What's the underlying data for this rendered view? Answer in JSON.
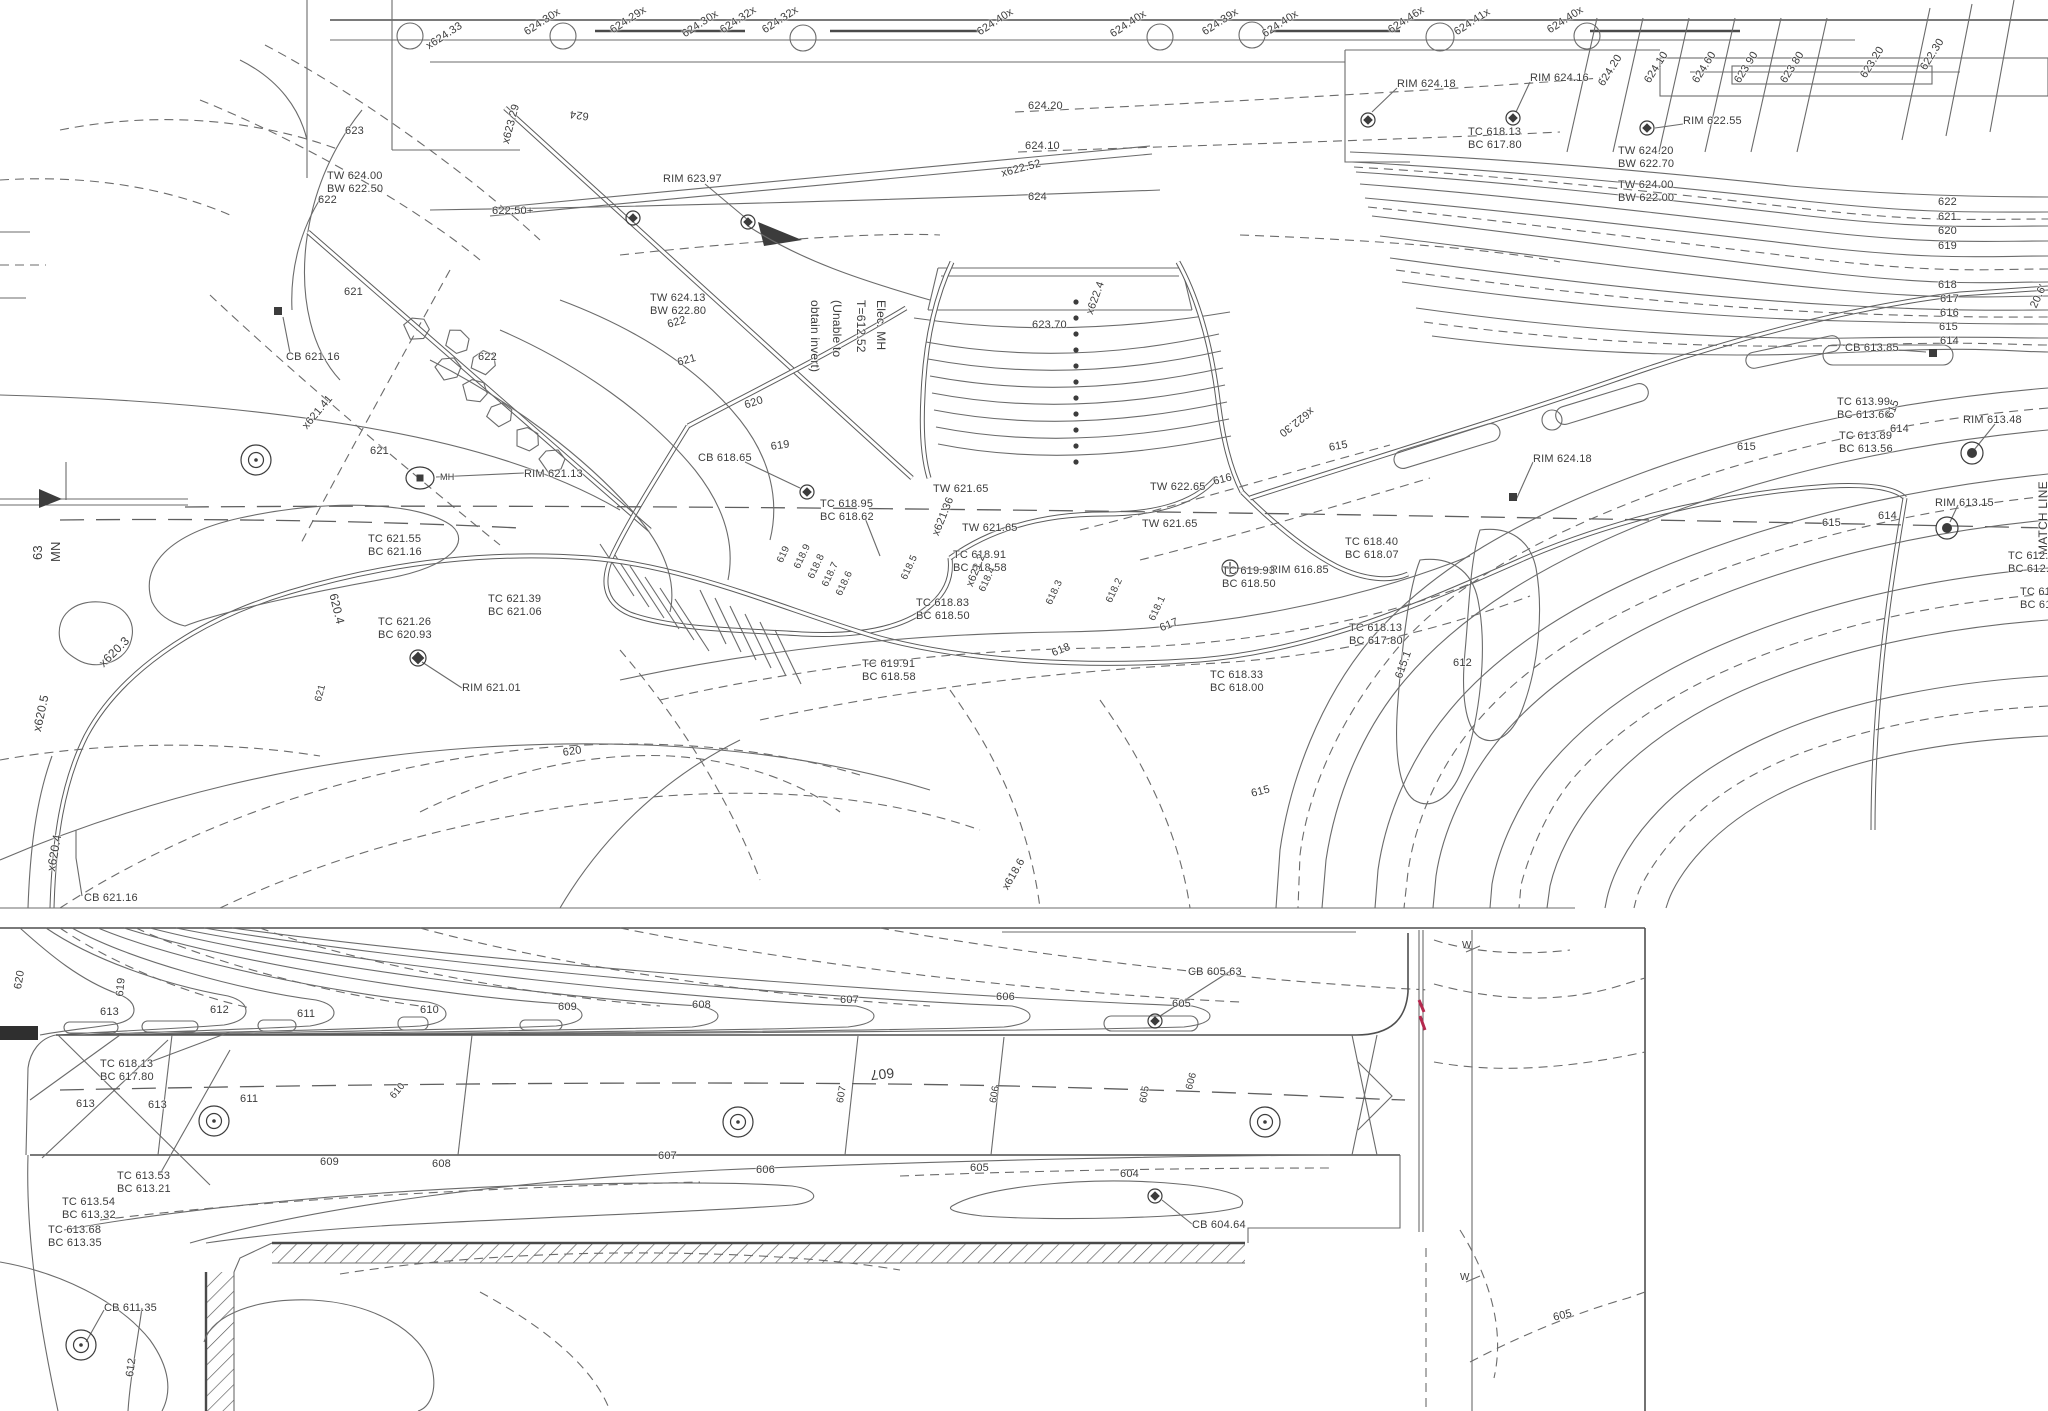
{
  "title": "site-grading-topographic-plan",
  "colors": {
    "paper": "#ffffff",
    "ink": "#3c3c3c",
    "line": "#6b6b6b",
    "flag": "#b5294e"
  },
  "panels": {
    "top": "plan-view-upper",
    "bottom": "plan-view-lower"
  },
  "notes": {
    "elec_mh": [
      "Elec. MH",
      "T=612.52",
      "(Unable to",
      "obtain invert)"
    ],
    "match_line": "MATCH LINE",
    "route": [
      "MN",
      "63"
    ]
  },
  "labels": [
    {
      "t": "x624.33",
      "x": 424,
      "y": 42,
      "r": -33
    },
    {
      "t": "624.30x",
      "x": 522,
      "y": 28,
      "r": -33
    },
    {
      "t": "624.29x",
      "x": 608,
      "y": 26,
      "r": -33
    },
    {
      "t": "624.30x",
      "x": 680,
      "y": 30,
      "r": -33
    },
    {
      "t": "624.32x",
      "x": 718,
      "y": 26,
      "r": -33
    },
    {
      "t": "624.32x",
      "x": 760,
      "y": 26,
      "r": -33
    },
    {
      "t": "624.40x",
      "x": 975,
      "y": 28,
      "r": -33
    },
    {
      "t": "624.40x",
      "x": 1108,
      "y": 30,
      "r": -33
    },
    {
      "t": "624.39x",
      "x": 1200,
      "y": 28,
      "r": -33
    },
    {
      "t": "624.40x",
      "x": 1260,
      "y": 30,
      "r": -33
    },
    {
      "t": "624.46x",
      "x": 1386,
      "y": 26,
      "r": -33
    },
    {
      "t": "624.41x",
      "x": 1452,
      "y": 28,
      "r": -33
    },
    {
      "t": "624.40x",
      "x": 1545,
      "y": 26,
      "r": -33
    },
    {
      "t": "624.20",
      "x": 1596,
      "y": 82,
      "r": -58
    },
    {
      "t": "624.10",
      "x": 1642,
      "y": 79,
      "r": -58
    },
    {
      "t": "624.60",
      "x": 1690,
      "y": 79,
      "r": -58
    },
    {
      "t": "623.90",
      "x": 1732,
      "y": 79,
      "r": -58
    },
    {
      "t": "623.80",
      "x": 1778,
      "y": 79,
      "r": -58
    },
    {
      "t": "623.20",
      "x": 1858,
      "y": 74,
      "r": -58
    },
    {
      "t": "622.30",
      "x": 1918,
      "y": 66,
      "r": -58
    },
    {
      "t": "RIM 624.18",
      "x": 1397,
      "y": 78
    },
    {
      "t": "RIM 624.16",
      "x": 1530,
      "y": 72
    },
    {
      "t": "RIM 622.55",
      "x": 1683,
      "y": 115
    },
    {
      "t": "RIM 623.97",
      "x": 663,
      "y": 173
    },
    {
      "t": "TC 618.13\nBC 617.80",
      "x": 1468,
      "y": 126
    },
    {
      "t": "TW 624.20\nBW 622.70",
      "x": 1618,
      "y": 145
    },
    {
      "t": "TW 624.00\nBW 622.00",
      "x": 1618,
      "y": 179
    },
    {
      "t": "TW 624.00\nBW 622.50",
      "x": 327,
      "y": 170
    },
    {
      "t": "TW 624.13\nBW 622.80",
      "x": 650,
      "y": 292
    },
    {
      "t": "623",
      "x": 345,
      "y": 125
    },
    {
      "t": "622",
      "x": 318,
      "y": 194
    },
    {
      "t": "624.20",
      "x": 1028,
      "y": 100
    },
    {
      "t": "624.10",
      "x": 1025,
      "y": 140
    },
    {
      "t": "624",
      "x": 1028,
      "y": 191
    },
    {
      "t": "622.50+",
      "x": 492,
      "y": 205
    },
    {
      "t": "x623.29",
      "x": 500,
      "y": 142,
      "r": -75
    },
    {
      "t": "624",
      "x": 588,
      "y": 122,
      "r": 187
    },
    {
      "t": "x622.52",
      "x": 1000,
      "y": 168,
      "r": -15
    },
    {
      "t": "623.70",
      "x": 1032,
      "y": 319
    },
    {
      "t": "x622.4",
      "x": 1084,
      "y": 312,
      "r": -70
    },
    {
      "t": "x622.30",
      "x": 1316,
      "y": 414,
      "r": 142
    },
    {
      "t": "622",
      "x": 1938,
      "y": 196
    },
    {
      "t": "621",
      "x": 1938,
      "y": 211
    },
    {
      "t": "620",
      "x": 1938,
      "y": 225
    },
    {
      "t": "619",
      "x": 1938,
      "y": 240
    },
    {
      "t": "618",
      "x": 1938,
      "y": 279
    },
    {
      "t": "617",
      "x": 1940,
      "y": 293
    },
    {
      "t": "616",
      "x": 1940,
      "y": 307
    },
    {
      "t": "615",
      "x": 1939,
      "y": 321
    },
    {
      "t": "614",
      "x": 1940,
      "y": 335
    },
    {
      "t": "CB 613.85",
      "x": 1845,
      "y": 342
    },
    {
      "t": "TC 613.99\nBC 613.66",
      "x": 1837,
      "y": 396
    },
    {
      "t": "TC 613.89\nBC 613.56",
      "x": 1839,
      "y": 430
    },
    {
      "t": "RIM 613.48",
      "x": 1963,
      "y": 414
    },
    {
      "t": "RIM 613.15",
      "x": 1935,
      "y": 497
    },
    {
      "t": "MATCH LINE",
      "x": 2036,
      "y": 555,
      "r": -90,
      "fs": 12
    },
    {
      "t": "TC 612.5\nBC 612.5",
      "x": 2008,
      "y": 550
    },
    {
      "t": "TC 612\nBC 612",
      "x": 2020,
      "y": 586
    },
    {
      "t": "20.6'",
      "x": 2028,
      "y": 305,
      "r": -65
    },
    {
      "t": "615",
      "x": 1737,
      "y": 441
    },
    {
      "t": "615",
      "x": 1884,
      "y": 416,
      "r": -70
    },
    {
      "t": "614",
      "x": 1890,
      "y": 423
    },
    {
      "t": "614",
      "x": 1878,
      "y": 510
    },
    {
      "t": "615",
      "x": 1822,
      "y": 517
    },
    {
      "t": "615.1",
      "x": 1393,
      "y": 676,
      "r": -70
    },
    {
      "t": "612",
      "x": 1453,
      "y": 657
    },
    {
      "t": "618",
      "x": 1050,
      "y": 648,
      "r": -22
    },
    {
      "t": "617",
      "x": 1158,
      "y": 623,
      "r": -22
    },
    {
      "t": "616",
      "x": 1212,
      "y": 476,
      "r": -14
    },
    {
      "t": "615",
      "x": 1328,
      "y": 442,
      "r": -10
    },
    {
      "t": "615",
      "x": 1250,
      "y": 788,
      "r": -14
    },
    {
      "t": "RIM 624.18",
      "x": 1533,
      "y": 453
    },
    {
      "t": "RIM 616.85",
      "x": 1270,
      "y": 564
    },
    {
      "t": "620",
      "x": 743,
      "y": 400,
      "r": -18
    },
    {
      "t": "621",
      "x": 676,
      "y": 357,
      "r": -15
    },
    {
      "t": "622",
      "x": 666,
      "y": 319,
      "r": -15
    },
    {
      "t": "619",
      "x": 770,
      "y": 441,
      "r": -8
    },
    {
      "t": "CB 618.65",
      "x": 698,
      "y": 452
    },
    {
      "t": "TC 618.95\nBC 618.62",
      "x": 820,
      "y": 498
    },
    {
      "t": "TW 621.65",
      "x": 933,
      "y": 483
    },
    {
      "t": "TW 621.65",
      "x": 962,
      "y": 522
    },
    {
      "t": "TW 621.65",
      "x": 1142,
      "y": 518
    },
    {
      "t": "TW 622.65",
      "x": 1150,
      "y": 481
    },
    {
      "t": "x621.36",
      "x": 930,
      "y": 533,
      "r": -68
    },
    {
      "t": "TC 618.91\nBC 618.58",
      "x": 953,
      "y": 549
    },
    {
      "t": "x621.2",
      "x": 964,
      "y": 584,
      "r": -68
    },
    {
      "t": "TC 618.83\nBC 618.50",
      "x": 916,
      "y": 597
    },
    {
      "t": "TC 619.91\nBC 618.58",
      "x": 862,
      "y": 658
    },
    {
      "t": "TC 619.93\nBC 618.50",
      "x": 1222,
      "y": 565
    },
    {
      "t": "TC 618.40\nBC 618.07",
      "x": 1345,
      "y": 536
    },
    {
      "t": "TC 618.13\nBC 617.80",
      "x": 1349,
      "y": 622
    },
    {
      "t": "TC 618.33\nBC 618.00",
      "x": 1210,
      "y": 669
    },
    {
      "t": "x618.6",
      "x": 1000,
      "y": 886,
      "r": -60
    },
    {
      "t": "619",
      "x": 775,
      "y": 560,
      "r": -65,
      "fs": 10
    },
    {
      "t": "618.9",
      "x": 792,
      "y": 566,
      "r": -65,
      "fs": 10
    },
    {
      "t": "618.8",
      "x": 806,
      "y": 576,
      "r": -65,
      "fs": 10
    },
    {
      "t": "618.7",
      "x": 820,
      "y": 584,
      "r": -65,
      "fs": 10
    },
    {
      "t": "618.6",
      "x": 834,
      "y": 593,
      "r": -65,
      "fs": 10
    },
    {
      "t": "618.5",
      "x": 899,
      "y": 577,
      "r": -65,
      "fs": 10
    },
    {
      "t": "618.4",
      "x": 977,
      "y": 589,
      "r": -65,
      "fs": 10
    },
    {
      "t": "618.3",
      "x": 1044,
      "y": 602,
      "r": -65,
      "fs": 10
    },
    {
      "t": "618.2",
      "x": 1104,
      "y": 600,
      "r": -65,
      "fs": 10
    },
    {
      "t": "618.1",
      "x": 1147,
      "y": 618,
      "r": -65,
      "fs": 10
    },
    {
      "t": "621",
      "x": 344,
      "y": 286
    },
    {
      "t": "CB 621.16",
      "x": 286,
      "y": 351
    },
    {
      "t": "x621.41",
      "x": 300,
      "y": 424,
      "r": -50
    },
    {
      "t": "622",
      "x": 478,
      "y": 351
    },
    {
      "t": "621",
      "x": 370,
      "y": 445
    },
    {
      "t": "MH",
      "x": 440,
      "y": 472,
      "fs": 9
    },
    {
      "t": "RIM 621.13",
      "x": 524,
      "y": 468
    },
    {
      "t": "TC 621.55\nBC 621.16",
      "x": 368,
      "y": 533
    },
    {
      "t": "TC 621.39\nBC 621.06",
      "x": 488,
      "y": 593
    },
    {
      "t": "TC 621.26\nBC 620.93",
      "x": 378,
      "y": 616
    },
    {
      "t": "RIM 621.01",
      "x": 462,
      "y": 682
    },
    {
      "t": "620.4",
      "x": 340,
      "y": 592,
      "r": 76,
      "fs": 12
    },
    {
      "t": "x620.3",
      "x": 96,
      "y": 660,
      "r": -45,
      "fs": 12
    },
    {
      "t": "x620.5",
      "x": 30,
      "y": 730,
      "r": -78,
      "fs": 12
    },
    {
      "t": "x620.4",
      "x": 44,
      "y": 870,
      "r": -80,
      "fs": 12
    },
    {
      "t": "621",
      "x": 313,
      "y": 700,
      "r": -75,
      "fs": 10
    },
    {
      "t": "620",
      "x": 562,
      "y": 747,
      "r": -8
    },
    {
      "t": "CB 621.16",
      "x": 84,
      "y": 892
    },
    {
      "t": "MN",
      "x": 48,
      "y": 562,
      "r": -90,
      "fs": 13
    },
    {
      "t": "63",
      "x": 30,
      "y": 560,
      "r": -90,
      "fs": 13
    },
    {
      "t": "Elec. MH",
      "x": 888,
      "y": 300,
      "r": 90,
      "fs": 12
    },
    {
      "t": "T=612.52",
      "x": 868,
      "y": 300,
      "r": 90,
      "fs": 12
    },
    {
      "t": "(Unable to",
      "x": 844,
      "y": 300,
      "r": 90,
      "fs": 12
    },
    {
      "t": "obtain invert)",
      "x": 822,
      "y": 300,
      "r": 90,
      "fs": 12
    },
    {
      "t": "613",
      "x": 100,
      "y": 1006
    },
    {
      "t": "612",
      "x": 210,
      "y": 1004
    },
    {
      "t": "611",
      "x": 297,
      "y": 1008
    },
    {
      "t": "610",
      "x": 420,
      "y": 1004
    },
    {
      "t": "609",
      "x": 558,
      "y": 1001
    },
    {
      "t": "608",
      "x": 692,
      "y": 999
    },
    {
      "t": "607",
      "x": 840,
      "y": 994
    },
    {
      "t": "606",
      "x": 996,
      "y": 991
    },
    {
      "t": "605",
      "x": 1172,
      "y": 998
    },
    {
      "t": "CB 605.63",
      "x": 1188,
      "y": 966
    },
    {
      "t": "610",
      "x": 388,
      "y": 1094,
      "r": -50,
      "fs": 10
    },
    {
      "t": "607",
      "x": 835,
      "y": 1102,
      "r": -80,
      "fs": 10
    },
    {
      "t": "607",
      "x": 895,
      "y": 1081,
      "r": 174,
      "fs": 14
    },
    {
      "t": "606",
      "x": 988,
      "y": 1102,
      "r": -80,
      "fs": 10
    },
    {
      "t": "605",
      "x": 1138,
      "y": 1102,
      "r": -80,
      "fs": 10
    },
    {
      "t": "606",
      "x": 1184,
      "y": 1088,
      "r": -75,
      "fs": 10
    },
    {
      "t": "609",
      "x": 320,
      "y": 1156
    },
    {
      "t": "608",
      "x": 432,
      "y": 1158
    },
    {
      "t": "607",
      "x": 658,
      "y": 1150
    },
    {
      "t": "606",
      "x": 756,
      "y": 1164
    },
    {
      "t": "605",
      "x": 970,
      "y": 1162
    },
    {
      "t": "604",
      "x": 1120,
      "y": 1168
    },
    {
      "t": "CB 604.64",
      "x": 1192,
      "y": 1219
    },
    {
      "t": "TC 618.13\nBC 617.80",
      "x": 100,
      "y": 1058
    },
    {
      "t": "613",
      "x": 76,
      "y": 1098
    },
    {
      "t": "613",
      "x": 148,
      "y": 1099
    },
    {
      "t": "611",
      "x": 240,
      "y": 1093
    },
    {
      "t": "TC 613.53\nBC 613.21",
      "x": 117,
      "y": 1170
    },
    {
      "t": "TC 613.54\nBC 613.32",
      "x": 62,
      "y": 1196
    },
    {
      "t": "TC 613.68\nBC 613.35",
      "x": 48,
      "y": 1224
    },
    {
      "t": "CB 611.35",
      "x": 104,
      "y": 1302
    },
    {
      "t": "612",
      "x": 124,
      "y": 1376,
      "r": -82
    },
    {
      "t": "619",
      "x": 114,
      "y": 996,
      "r": -85
    },
    {
      "t": "620",
      "x": 12,
      "y": 988,
      "r": -80
    },
    {
      "t": "W",
      "x": 1462,
      "y": 940,
      "fs": 10
    },
    {
      "t": "W",
      "x": 1460,
      "y": 1272,
      "fs": 10
    },
    {
      "t": "605",
      "x": 1552,
      "y": 1312,
      "r": -14
    }
  ],
  "symbols": [
    {
      "k": "cb",
      "x": 1368,
      "y": 120
    },
    {
      "k": "cb",
      "x": 1513,
      "y": 118
    },
    {
      "k": "cb",
      "x": 1647,
      "y": 128
    },
    {
      "k": "cb",
      "x": 633,
      "y": 218
    },
    {
      "k": "cb",
      "x": 748,
      "y": 222
    },
    {
      "k": "sq",
      "x": 278,
      "y": 311
    },
    {
      "k": "cb",
      "x": 807,
      "y": 492
    },
    {
      "k": "mh",
      "x": 420,
      "y": 478
    },
    {
      "k": "target",
      "x": 256,
      "y": 460
    },
    {
      "k": "dia",
      "x": 418,
      "y": 658
    },
    {
      "k": "cross",
      "x": 1230,
      "y": 568
    },
    {
      "k": "sq",
      "x": 1513,
      "y": 497
    },
    {
      "k": "target2",
      "x": 1972,
      "y": 453
    },
    {
      "k": "target2",
      "x": 1947,
      "y": 528
    },
    {
      "k": "sq",
      "x": 1933,
      "y": 353
    },
    {
      "k": "target",
      "x": 214,
      "y": 1121
    },
    {
      "k": "target",
      "x": 738,
      "y": 1122
    },
    {
      "k": "target",
      "x": 1265,
      "y": 1122
    },
    {
      "k": "cb",
      "x": 1155,
      "y": 1021
    },
    {
      "k": "cb",
      "x": 1155,
      "y": 1196
    },
    {
      "k": "target",
      "x": 81,
      "y": 1345
    }
  ]
}
